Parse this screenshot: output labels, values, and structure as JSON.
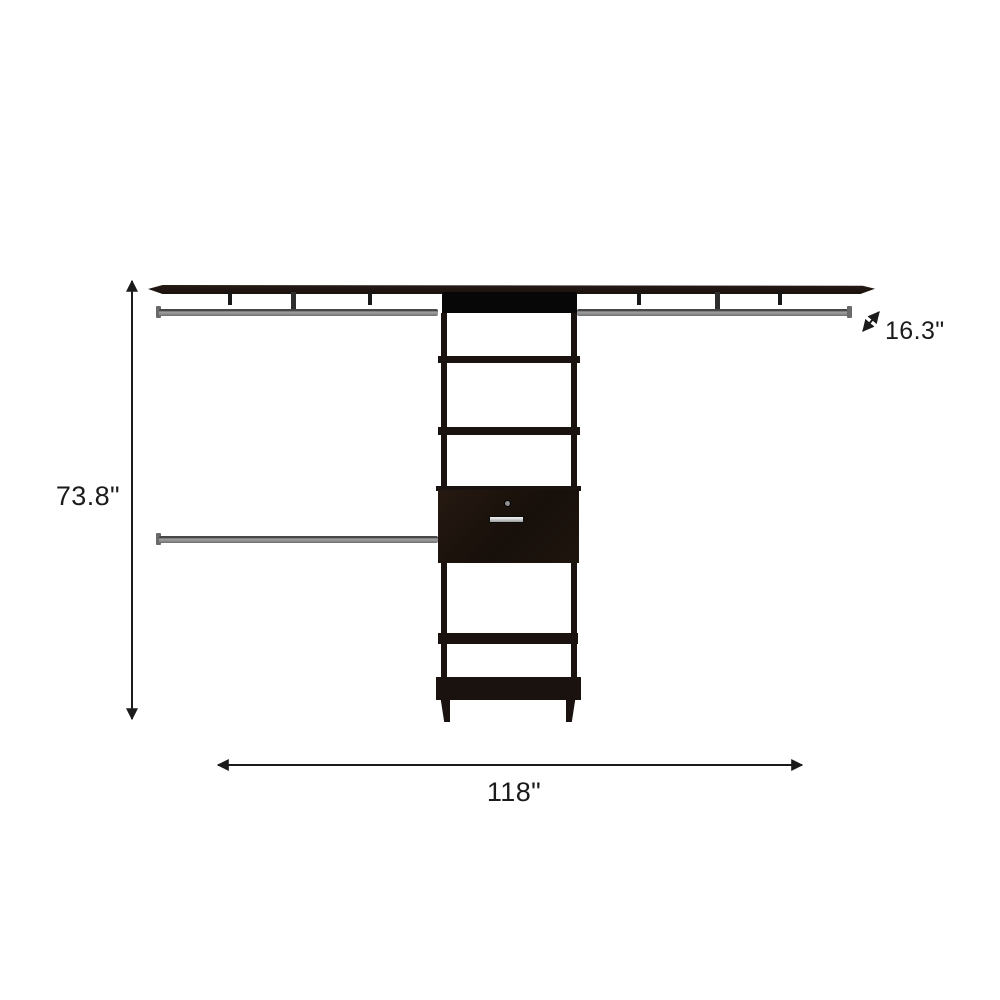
{
  "diagram": {
    "labels": {
      "height": "73.8\"",
      "width": "118\"",
      "depth": "16.3\""
    },
    "icons": {
      "height_arrow": "vertical-double-arrow",
      "width_arrow": "horizontal-double-arrow",
      "depth_arrow": "diagonal-double-arrow"
    }
  },
  "colors": {
    "background": "#ffffff",
    "wood": "#1a120e",
    "panel_black": "#070707",
    "rod_gray": "#8e8e8e",
    "rod_dark": "#474747",
    "handle_silver": "#d6d6d6",
    "annotation": "#1b1b1b"
  }
}
